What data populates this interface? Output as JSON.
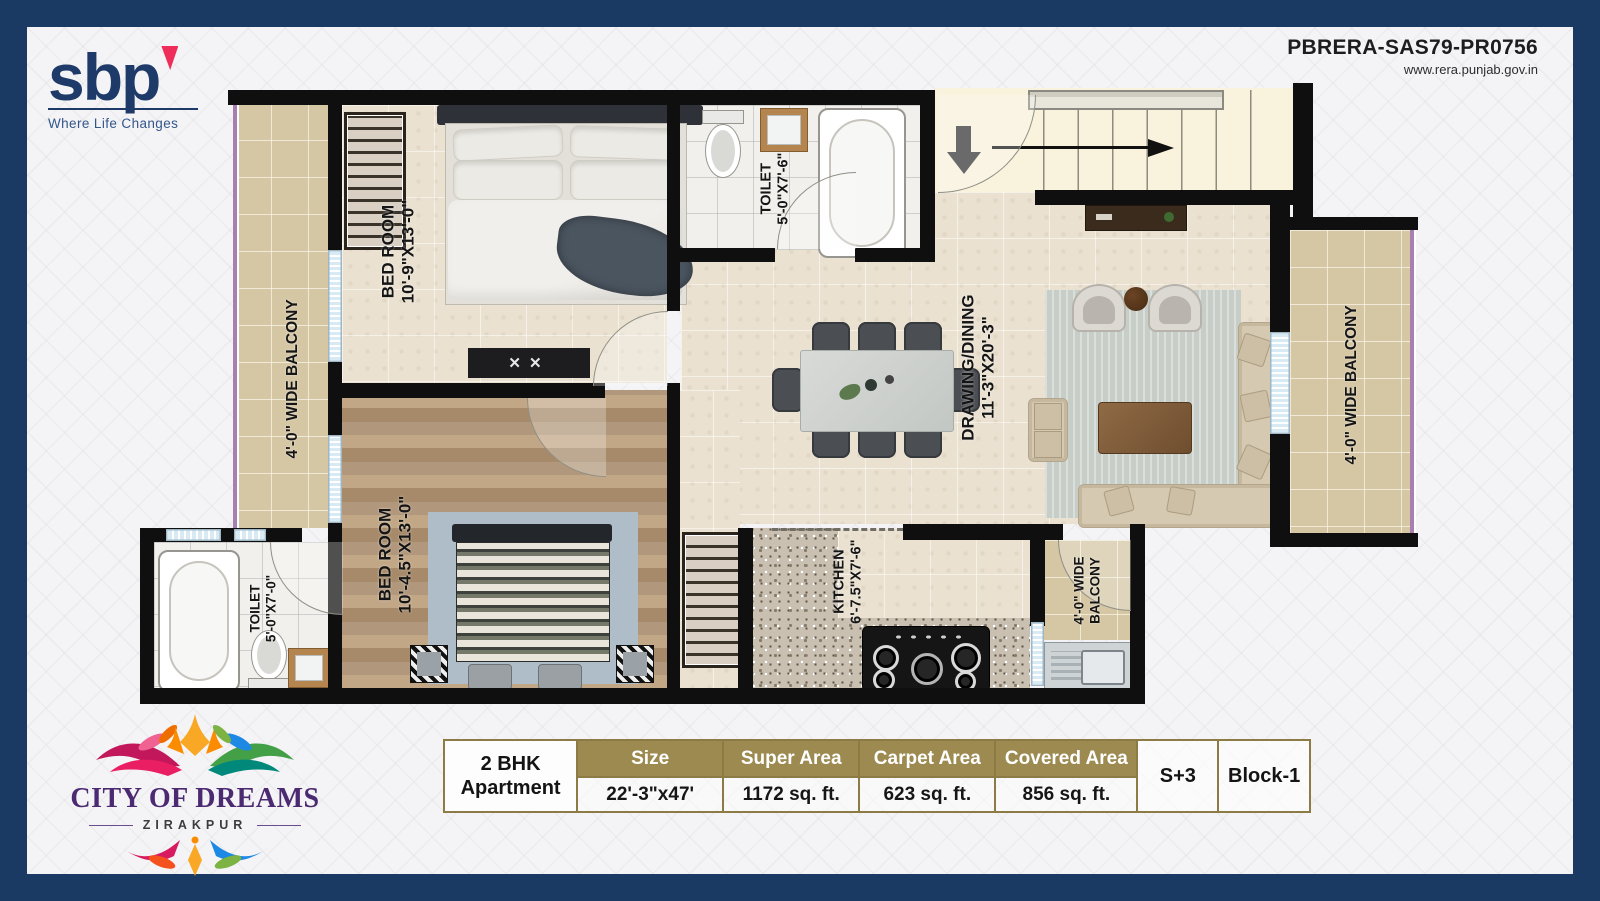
{
  "brand": {
    "name": "sbp",
    "tagline": "Where Life Changes"
  },
  "rera": {
    "id": "PBRERA-SAS79-PR0756",
    "url": "www.rera.punjab.gov.in"
  },
  "project": {
    "name": "CITY OF DREAMS",
    "location": "ZIRAKPUR"
  },
  "rooms": {
    "bedroom1": {
      "name": "BED ROOM",
      "dims": "10'-9\"X13'-0\""
    },
    "toilet1": {
      "name": "TOILET",
      "dims": "5'-0\"X7'-6\""
    },
    "drawing": {
      "name": "DRAWING/DINING",
      "dims": "11'-3\"X20'-3\""
    },
    "bedroom2": {
      "name": "BED ROOM",
      "dims": "10'-4.5\"X13'-0\""
    },
    "toilet2": {
      "name": "TOILET",
      "dims": "5'-0\"X7'-0\""
    },
    "kitchen": {
      "name": "KITCHEN",
      "dims": "6'-7.5\"X7'-6\""
    },
    "balcony_left": {
      "name": "4'-0\" WIDE BALCONY"
    },
    "balcony_right": {
      "name": "4'-0\" WIDE BALCONY"
    },
    "balcony_utility": {
      "line1": "4'-0\" WIDE",
      "line2": "BALCONY"
    }
  },
  "bench_marks": "✕✕",
  "spec_table": {
    "unit": {
      "line1": "2 BHK",
      "line2": "Apartment"
    },
    "columns": [
      {
        "header": "Size",
        "value": "22'-3\"x47'"
      },
      {
        "header": "Super Area",
        "value": "1172 sq. ft."
      },
      {
        "header": "Carpet Area",
        "value": "623 sq. ft."
      },
      {
        "header": "Covered Area",
        "value": "856 sq. ft."
      }
    ],
    "floors": "S+3",
    "block": "Block-1"
  },
  "colors": {
    "frame_navy": "#1b3a63",
    "table_gold": "#9d8a50",
    "brand_pink": "#ee2d5a",
    "logo_purple": "#4b2a72",
    "wall_black": "#0f0f0f",
    "floor_beige": "#eae1d1",
    "balcony_tan": "#d5c6a4",
    "wood_floor": "#b89b79",
    "stairs_cream": "#f9f2dc"
  }
}
